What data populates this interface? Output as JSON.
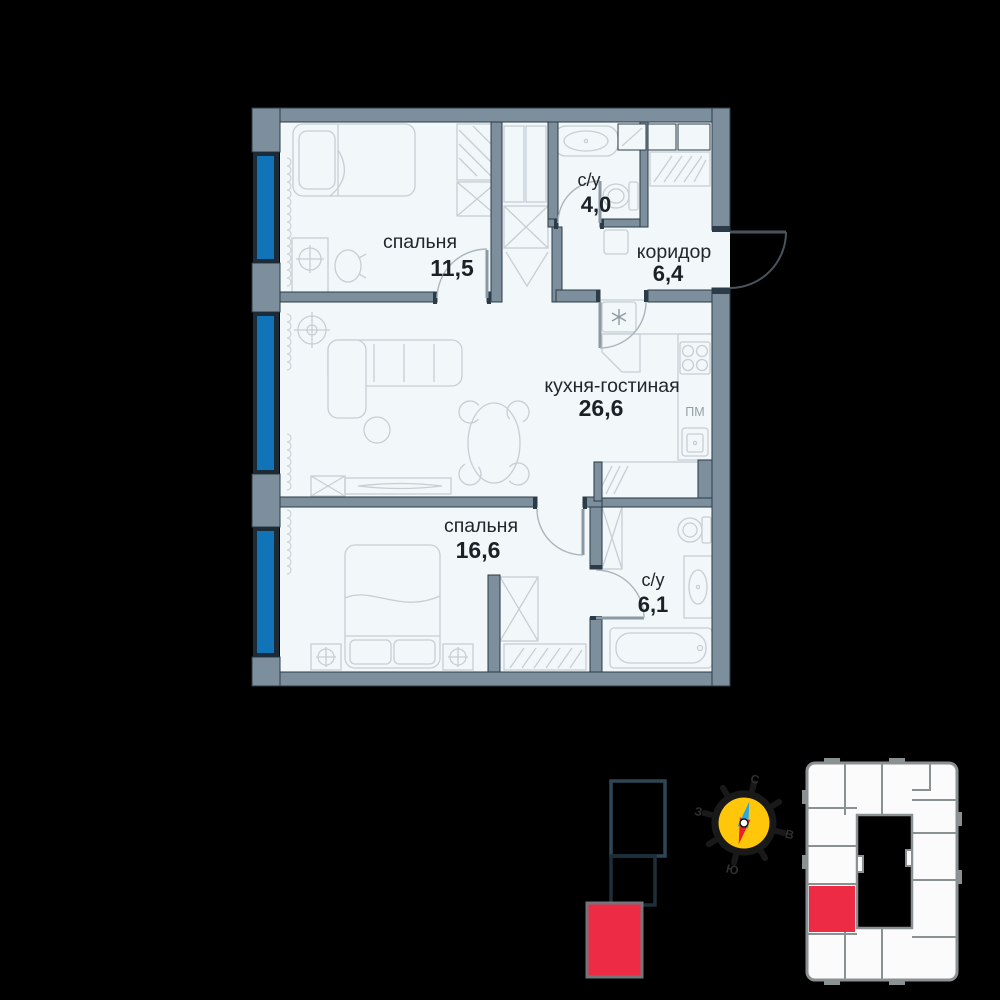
{
  "floor_plan": {
    "rooms": [
      {
        "id": "bedroom-1",
        "name": "спальня",
        "area": "11,5"
      },
      {
        "id": "bathroom-1",
        "name": "с/у",
        "area": "4,0"
      },
      {
        "id": "corridor",
        "name": "коридор",
        "area": "6,4"
      },
      {
        "id": "kitchen-living",
        "name": "кухня-гостиная",
        "area": "26,6"
      },
      {
        "id": "bedroom-2",
        "name": "спальня",
        "area": "16,6"
      },
      {
        "id": "bathroom-2",
        "name": "с/у",
        "area": "6,1"
      }
    ],
    "appliance_labels": {
      "dishwasher": "ПМ"
    }
  },
  "compass": {
    "north": "С",
    "east": "В",
    "south": "Ю",
    "west": "З"
  },
  "colors": {
    "background": "#000000",
    "wall": "#7d8f9c",
    "interior": "#f2f7f9",
    "window_glazing": "#1173b8",
    "accent_red": "#ee2b45",
    "compass_yellow": "#ffc60a",
    "compass_needle_blue": "#2aa9e0",
    "compass_needle_red": "#e8212e"
  }
}
